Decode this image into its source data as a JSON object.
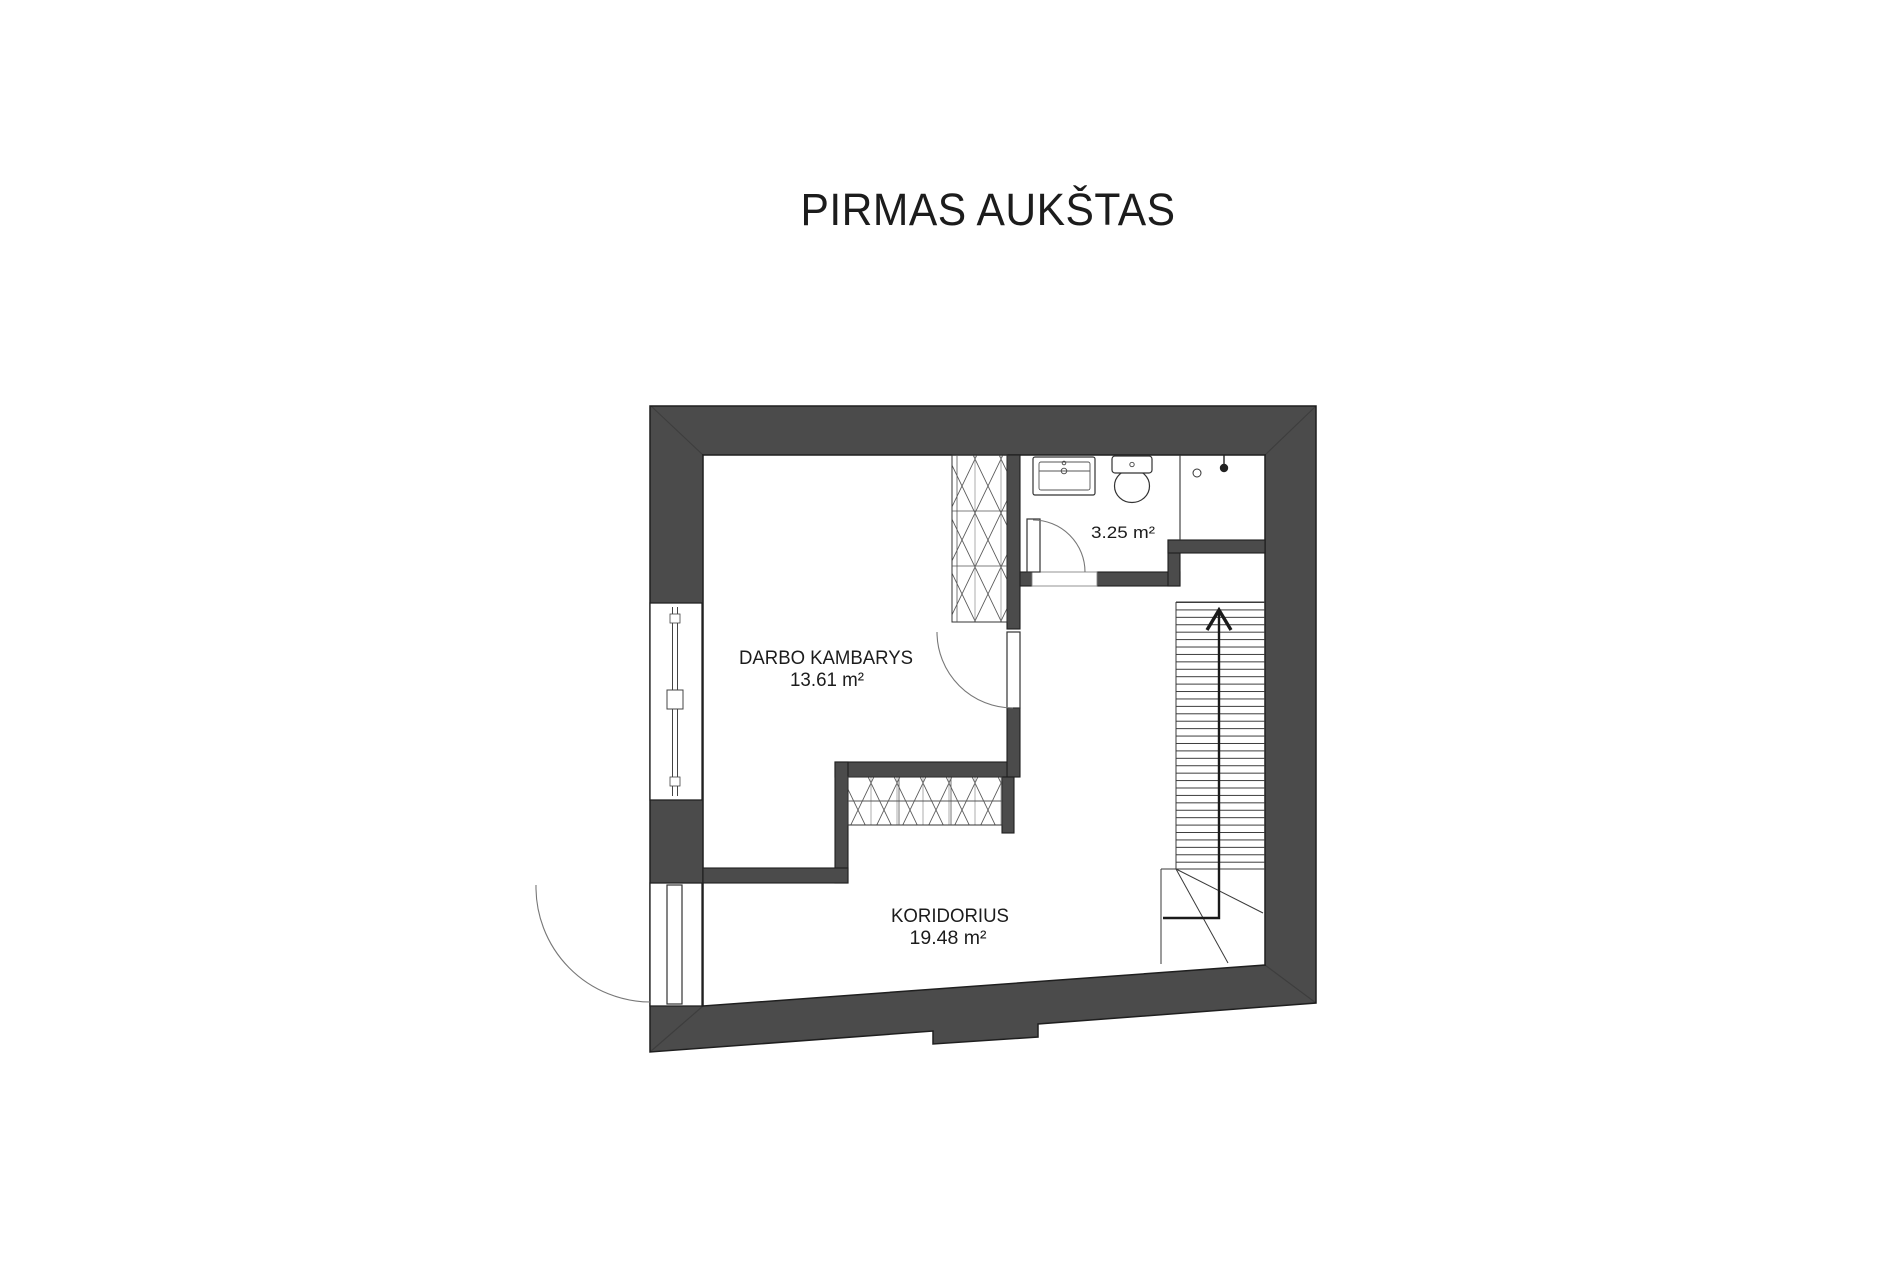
{
  "title": "PIRMAS AUKŠTAS",
  "rooms": {
    "workroom": {
      "name": "DARBO KAMBARYS",
      "area": "13.61 m²"
    },
    "corridor": {
      "name": "KORIDORIUS",
      "area": "19.48 m²"
    },
    "bathroom": {
      "name": "",
      "area": "3.25 m²"
    }
  },
  "stairs": {
    "direction_arrow": "up"
  },
  "fixture_icons": [
    "sink-icon",
    "toilet-icon",
    "shower-head-icon",
    "shower-drain-icon"
  ],
  "colors": {
    "background": "#ffffff",
    "wall_fill": "#4b4b4b",
    "outline": "#1f1f1f",
    "thin_line": "#3a3a3a",
    "text": "#1c1c1c"
  }
}
